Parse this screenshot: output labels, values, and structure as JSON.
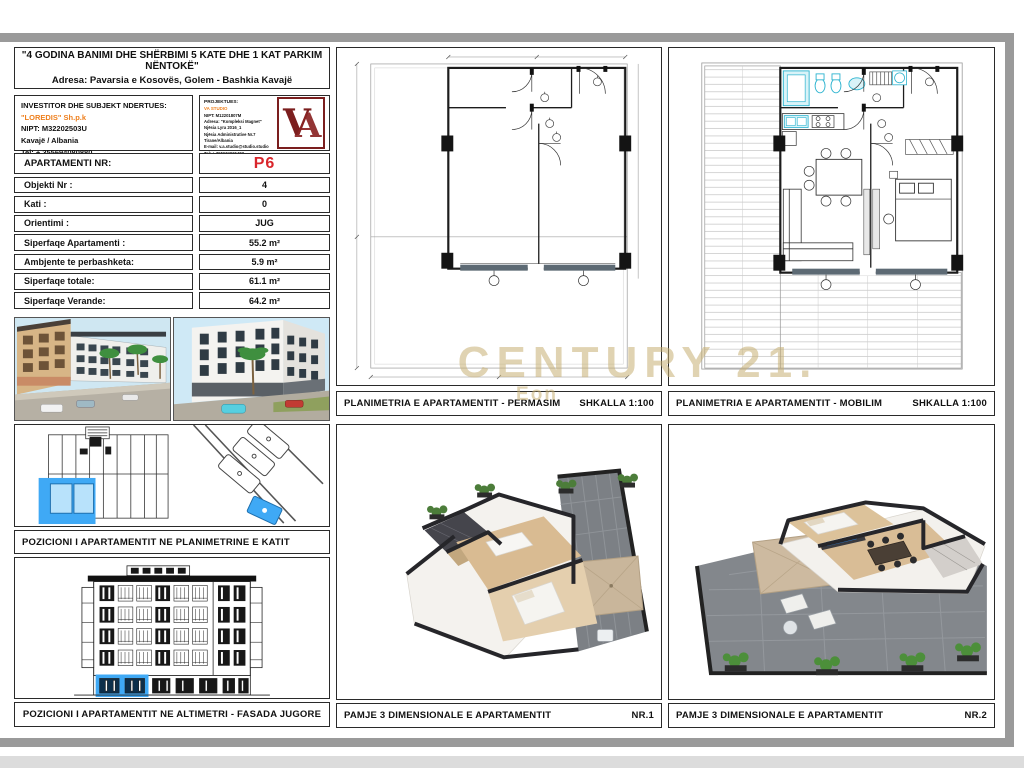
{
  "title_block": {
    "line1": "\"4 GODINA BANIMI DHE SHËRBIMI 5 KATE DHE 1 KAT PARKIM NËNTOKË\"",
    "line2": "Adresa: Pavarsia e Kosovës, Golem - Bashkia Kavajë"
  },
  "investor": {
    "heading": "INVESTITOR DHE SUBJEKT NDERTUES:",
    "company": "\"LOREDIS\" Sh.p.k",
    "nipt": "NIPT: M32202503U",
    "city": "Kavajë / Albania",
    "tel": "Tel: + 355694080880"
  },
  "designer": {
    "heading": "PROJEKTUES:",
    "company": "VA STUDIO",
    "lines": [
      "NIPT: M12201807M",
      "Adresa: \"Kompleksi Magnet\"",
      "Njësia Lyra 2016_1",
      "Njësia Administrative Nr.7",
      "Tirane/Albania",
      "E-mail: v.a.studio@studio.studio",
      "Tel: + 355674065407"
    ],
    "logo_letters": "VA"
  },
  "info_table": {
    "header": {
      "label": "APARTAMENTI  NR:",
      "value": "P6"
    },
    "rows": [
      {
        "label": "Objekti Nr :",
        "value": "4"
      },
      {
        "label": "Kati :",
        "value": "0"
      },
      {
        "label": "Orientimi :",
        "value": "JUG"
      },
      {
        "label": "Siperfaqe Apartamenti :",
        "value": "55.2 m²"
      },
      {
        "label": "Ambjente te perbashketa:",
        "value": "5.9 m²"
      },
      {
        "label": "Siperfaqe totale:",
        "value": "61.1 m²"
      },
      {
        "label": "Siperfaqe Verande:",
        "value": "64.2 m²"
      }
    ]
  },
  "captions": {
    "position_plan": "POZICIONI I APARTAMENTIT NE PLANIMETRINE E KATIT",
    "position_elevation": "POZICIONI I APARTAMENTIT NE ALTIMETRI - FASADA JUGORE",
    "plan_permasim": {
      "title": "PLANIMETRIA E APARTAMENTIT - PERMASIM",
      "scale": "SHKALLA 1:100"
    },
    "plan_mobilim": {
      "title": "PLANIMETRIA E APARTAMENTIT - MOBILIM",
      "scale": "SHKALLA 1:100"
    },
    "view3d_1": {
      "title": "PAMJE 3 DIMENSIONALE E APARTAMENTIT",
      "number": "NR.1"
    },
    "view3d_2": {
      "title": "PAMJE 3 DIMENSIONALE E APARTAMENTIT",
      "number": "NR.2"
    }
  },
  "watermark": {
    "line1": "CENTURY 21.",
    "line2": "Eon"
  },
  "colors": {
    "apartment_number_red": "#d9262c",
    "investor_orange": "#ee7f1d",
    "highlight_blue": "#3fa9f5",
    "watermark_gold": "#c6af73",
    "logo_dark_red": "#7b1e1e"
  }
}
